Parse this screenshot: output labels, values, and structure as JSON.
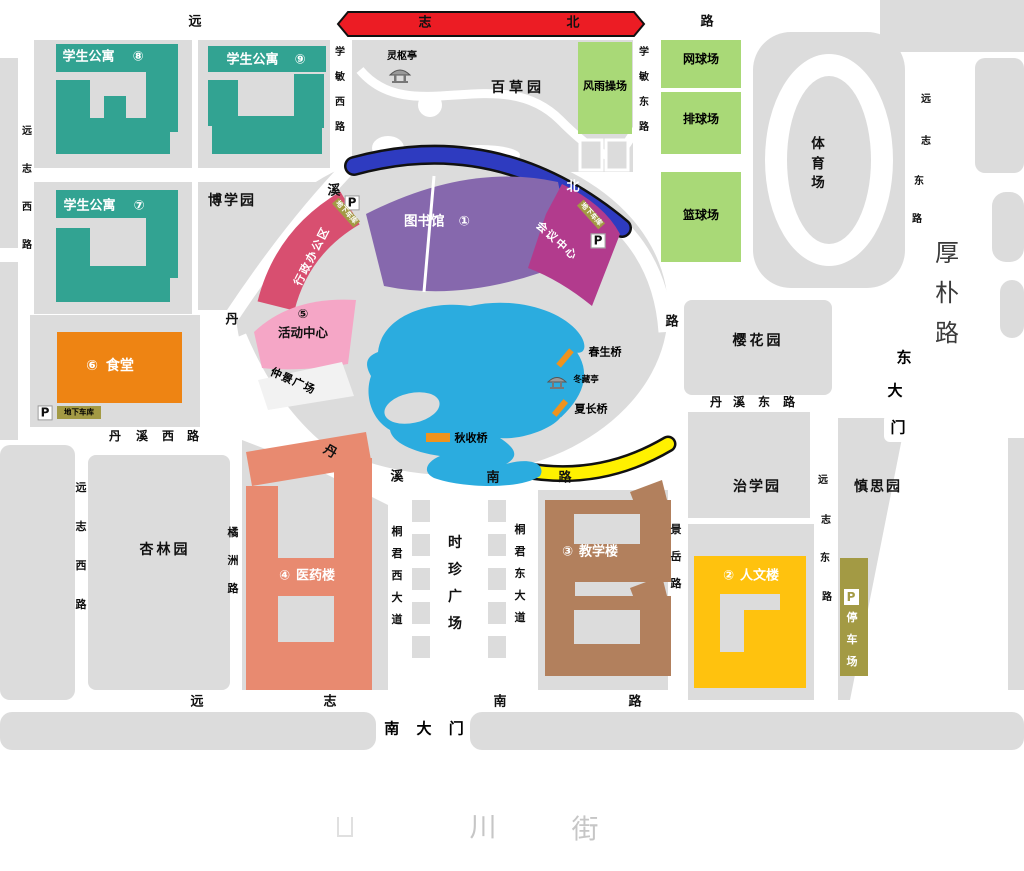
{
  "roads": {
    "yuanzhi_north": {
      "chars": [
        "远",
        "志",
        "北",
        "路"
      ]
    },
    "xuemin_west": {
      "chars": [
        "学",
        "敏",
        "西",
        "路"
      ]
    },
    "xuemin_east": {
      "chars": [
        "学",
        "敏",
        "东",
        "路"
      ]
    },
    "yuanzhi_west_upper": {
      "chars": [
        "远",
        "志",
        "西",
        "路"
      ]
    },
    "yuanzhi_west_lower": {
      "chars": [
        "远",
        "志",
        "西",
        "路"
      ]
    },
    "danxi_ring": {
      "chars": [
        "丹",
        "溪",
        "北",
        "路"
      ]
    },
    "danxi_west": {
      "chars": [
        "丹",
        "溪",
        "西",
        "路"
      ]
    },
    "danxi_south": {
      "chars": [
        "丹",
        "溪",
        "南",
        "路"
      ]
    },
    "danxi_east": {
      "chars": [
        "丹",
        "溪",
        "东",
        "路"
      ]
    },
    "tongjun_west": {
      "chars": [
        "桐",
        "君",
        "西",
        "大",
        "道"
      ]
    },
    "tongjun_east": {
      "chars": [
        "桐",
        "君",
        "东",
        "大",
        "道"
      ]
    },
    "jingyue": {
      "chars": [
        "景",
        "岳",
        "路"
      ]
    },
    "juzhou": {
      "chars": [
        "橘",
        "洲",
        "路"
      ]
    },
    "yuanzhi_east_upper": {
      "chars": [
        "远",
        "志",
        "东",
        "路"
      ]
    },
    "yuanzhi_east_lower": {
      "chars": [
        "远",
        "志",
        "东",
        "路"
      ]
    },
    "houpo": {
      "chars": [
        "厚",
        "朴",
        "路"
      ]
    },
    "yuanzhi_south": {
      "chars": [
        "远",
        "志",
        "南",
        "路"
      ]
    }
  },
  "gates": {
    "south": "南 大 门",
    "east": {
      "chars": [
        "东",
        "大",
        "门"
      ]
    }
  },
  "buildings": {
    "dorm8": {
      "name": "学生公寓",
      "num": "⑧"
    },
    "dorm9": {
      "name": "学生公寓",
      "num": "⑨"
    },
    "dorm7": {
      "name": "学生公寓",
      "num": "⑦"
    },
    "library": {
      "name": "图书馆",
      "num": "①"
    },
    "conference": {
      "name": "会议中心"
    },
    "admin": {
      "name": "行政办公区"
    },
    "activity": {
      "name": "活动中心",
      "num": "⑤"
    },
    "canteen": {
      "name": "食堂",
      "num": "⑥"
    },
    "medicine": {
      "name": "医药楼",
      "num": "④"
    },
    "teaching": {
      "name": "教学楼",
      "num": "③"
    },
    "humanities": {
      "name": "人文楼",
      "num": "②"
    },
    "covered_playground": "风雨操场",
    "tennis": "网球场",
    "volleyball": "排球场",
    "basketball": "篮球场",
    "stadium": {
      "chars": [
        "体",
        "育",
        "场"
      ]
    }
  },
  "gardens": {
    "boxue": "博学园",
    "baicao": "百草园",
    "xinglin": "杏林园",
    "yinghua": "樱花园",
    "zhixue": "治学园",
    "shensi": "慎思园"
  },
  "plaza": {
    "shizhen": {
      "chars": [
        "时",
        "珍",
        "广",
        "场"
      ]
    },
    "zhongjing": "仲景广场"
  },
  "pavilions": {
    "lingshu": "灵枢亭",
    "dongcang": "冬藏亭"
  },
  "bridges": {
    "spring": "春生桥",
    "summer": "夏长桥",
    "autumn": "秋收桥"
  },
  "parking": {
    "p": "P",
    "underground": "地下车库",
    "lot": {
      "chars": [
        "停",
        "车",
        "场"
      ]
    }
  },
  "faint_street": {
    "char_a": "川",
    "char_b": "街"
  },
  "colors": {
    "parcel_gray": "#dcdcdc",
    "dorm_teal": "#32a392",
    "court_green": "#a9d977",
    "highlight_red": "#ec1c24",
    "highlight_blue": "#2e3bc0",
    "highlight_yellow": "#fff100",
    "library_purple": "#8668ad",
    "conference_magenta": "#b23b8d",
    "admin_rose": "#d84f70",
    "activity_pink": "#f5a6c6",
    "canteen_orange": "#ee8413",
    "medicine_salmon": "#e88a70",
    "teaching_brown": "#b2805d",
    "humanities_gold": "#ffc20e",
    "olive_parking": "#a39a44",
    "lake_blue": "#2bacdf",
    "bridge_orange": "#ef931d"
  }
}
